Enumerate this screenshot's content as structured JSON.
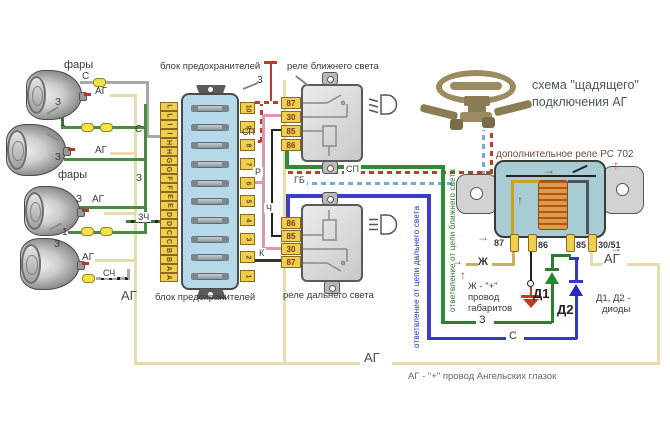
{
  "title": {
    "line1": "схема \"щадящего\"",
    "line2": "подключения АГ"
  },
  "annotations": {
    "aux_relay": "дополнительное реле РС 702",
    "fuse_top": "блок предохранителей",
    "fuse_bottom": "блок предохранителей",
    "relay_low": "реле ближнего света",
    "relay_high": "реле дальнего света",
    "branch_high": "ответвление от цепи дальнего света",
    "branch_low": "ответвление от цепи ближнего света",
    "zh_note_1": "Ж - \"+\"",
    "zh_note_2": "провод",
    "zh_note_3": "габаритов",
    "diode_note_1": "Д1, Д2 -",
    "diode_note_2": "диоды",
    "ag_note": "АГ - \"+\" провод Ангельских глазок",
    "headlights": "фары",
    "callout_1": "1",
    "callout_3": "3"
  },
  "wires": {
    "s": "С",
    "ag": "АГ",
    "z": "З",
    "zch": "ЗЧ",
    "sch": "СЧ",
    "zh": "Ж",
    "sp": "СП",
    "gb": "ГБ",
    "r": "Р",
    "ch": "Ч",
    "k": "К",
    "d1": "Д1",
    "d2": "Д2"
  },
  "fuse_block": {
    "letters": [
      "L",
      "L",
      "I",
      "I",
      "H",
      "H",
      "G",
      "G",
      "F",
      "F",
      "E",
      "E",
      "D",
      "D",
      "C",
      "C",
      "B",
      "B",
      "A",
      "A"
    ],
    "numbers": [
      "10",
      "9",
      "8",
      "7",
      "6",
      "5",
      "4",
      "3",
      "2",
      "1"
    ]
  },
  "low_pins": [
    "87",
    "30",
    "85",
    "86"
  ],
  "high_pins": [
    "86",
    "85",
    "30",
    "87"
  ],
  "aux_pins": [
    "87",
    "86",
    "85",
    "30/51"
  ],
  "colors": {
    "fuse_block": "#b5d9e8",
    "terminal_yellow": "#f0cf4f",
    "relay_gray": "#d9d9d9",
    "aux_relay_teal": "#a7ccd4",
    "coil_orange": "#e09a50",
    "wire_ag_beige": "#e7dcab",
    "wire_zh_yellow": "#c6b25e",
    "wire_z_green": "#4b8b3f",
    "branch_low_green": "#2e8b36",
    "branch_high_blue": "#3a3ecb",
    "wire_sp_red": "#c0392b",
    "wire_gb_blue": "#74a9d8",
    "wire_r_pink": "#d898b4",
    "wire_ch_black": "#222222",
    "ground_red": "#c0392b",
    "steering_tan": "#9a8c60"
  }
}
